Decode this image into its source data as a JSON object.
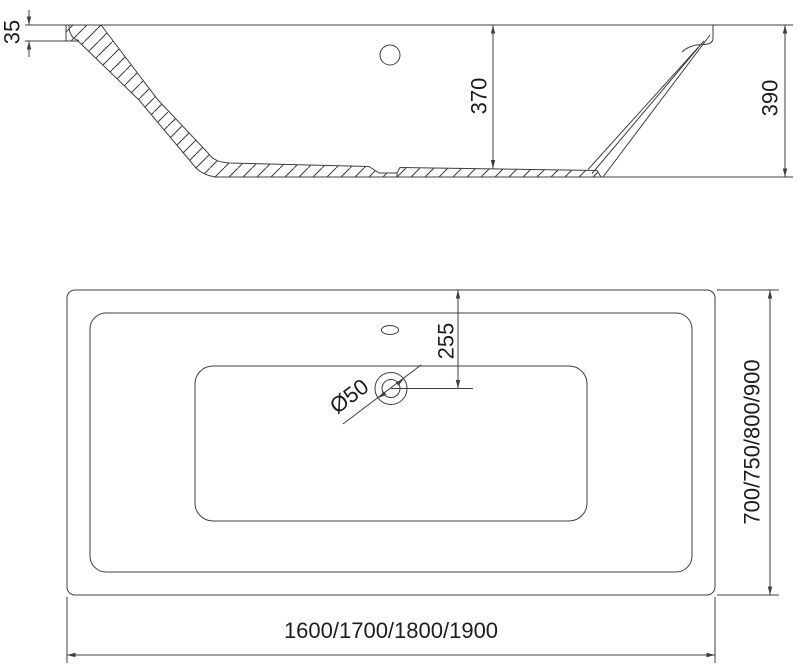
{
  "drawing": {
    "background": "#ffffff",
    "line_color": "#3f3f3f",
    "text_color": "#1d1d1d",
    "section_view": {
      "rim_thickness_mm": "35",
      "inner_depth_mm": "370",
      "overall_height_mm": "390"
    },
    "plan_view": {
      "drain_offset_mm": "255",
      "drain_diameter": "Ø50",
      "length_variants_mm": "1600/1700/1800/1900",
      "width_variants_mm": "700/750/800/900"
    }
  }
}
